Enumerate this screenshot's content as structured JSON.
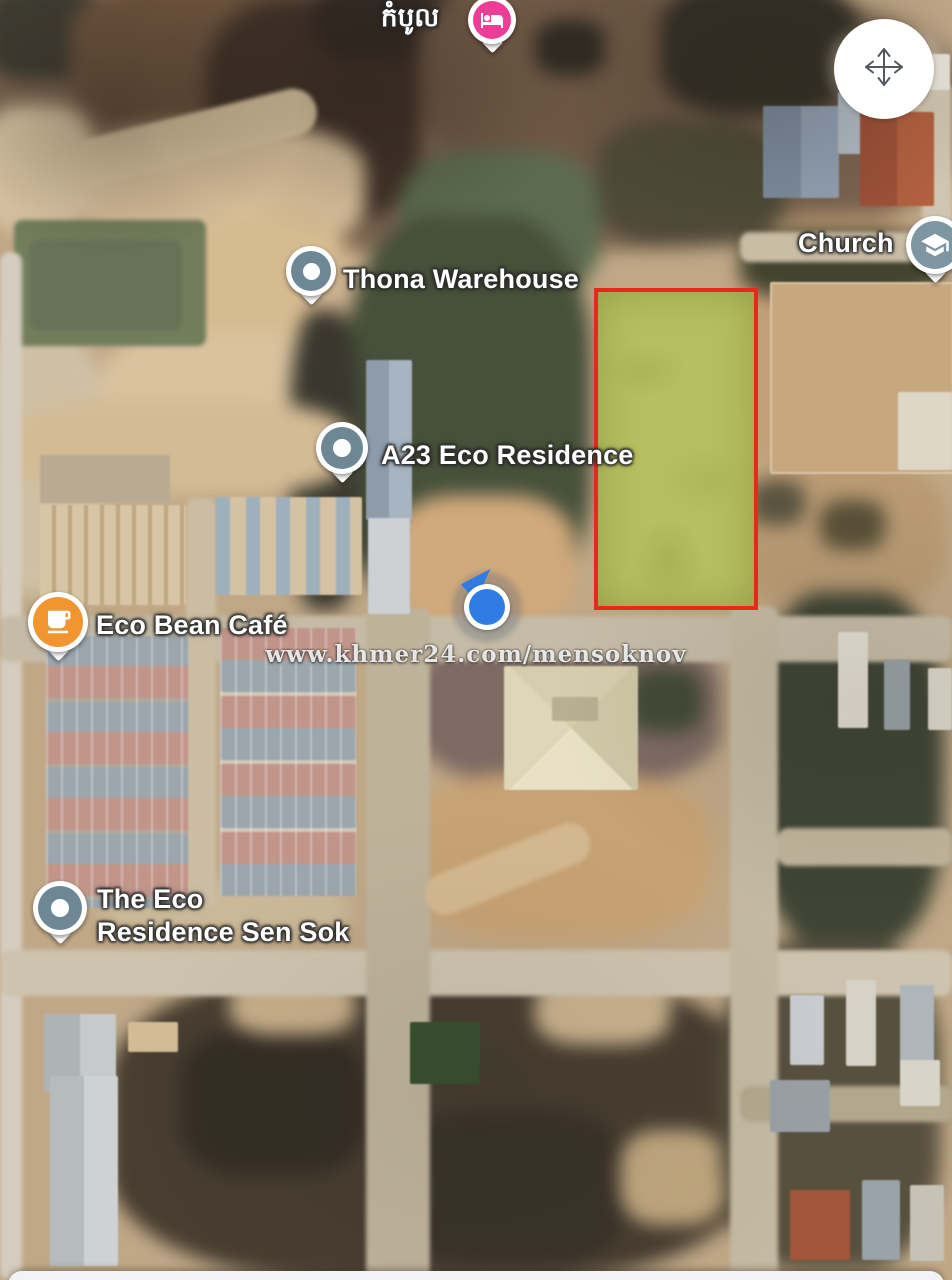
{
  "map": {
    "type": "satellite",
    "watermark": {
      "text": "www.khmer24.com/mensoknov"
    },
    "pins": {
      "kambol": {
        "label": "កំបូល",
        "icon": "bed-lodging-icon",
        "pin_color": "#ee3d96"
      },
      "thona": {
        "label": "Thona Warehouse",
        "icon": "poi-dot-icon",
        "pin_color": "#6e8795"
      },
      "church": {
        "label": "Church",
        "icon": "graduation-cap-icon",
        "pin_color": "#7d96a2"
      },
      "a23": {
        "label": "A23 Eco Residence",
        "icon": "poi-dot-icon",
        "pin_color": "#6e8795"
      },
      "ecobean": {
        "label": "Eco Bean Café",
        "icon": "coffee-cup-icon",
        "pin_color": "#f0952f"
      },
      "ecoresidence": {
        "label_line1": "The Eco",
        "label_line2": "Residence Sen Sok",
        "icon": "poi-dot-icon",
        "pin_color": "#6e8795"
      }
    },
    "highlight_plot": {
      "fill_color": "#b6c05f",
      "border_color": "#e8281a"
    },
    "location_indicator": {
      "color": "#2f7ce5",
      "heading": "north-east"
    },
    "controls": {
      "pan_button_icon": "move-arrows-icon"
    },
    "bottom_sheet": {
      "visible": true
    }
  }
}
